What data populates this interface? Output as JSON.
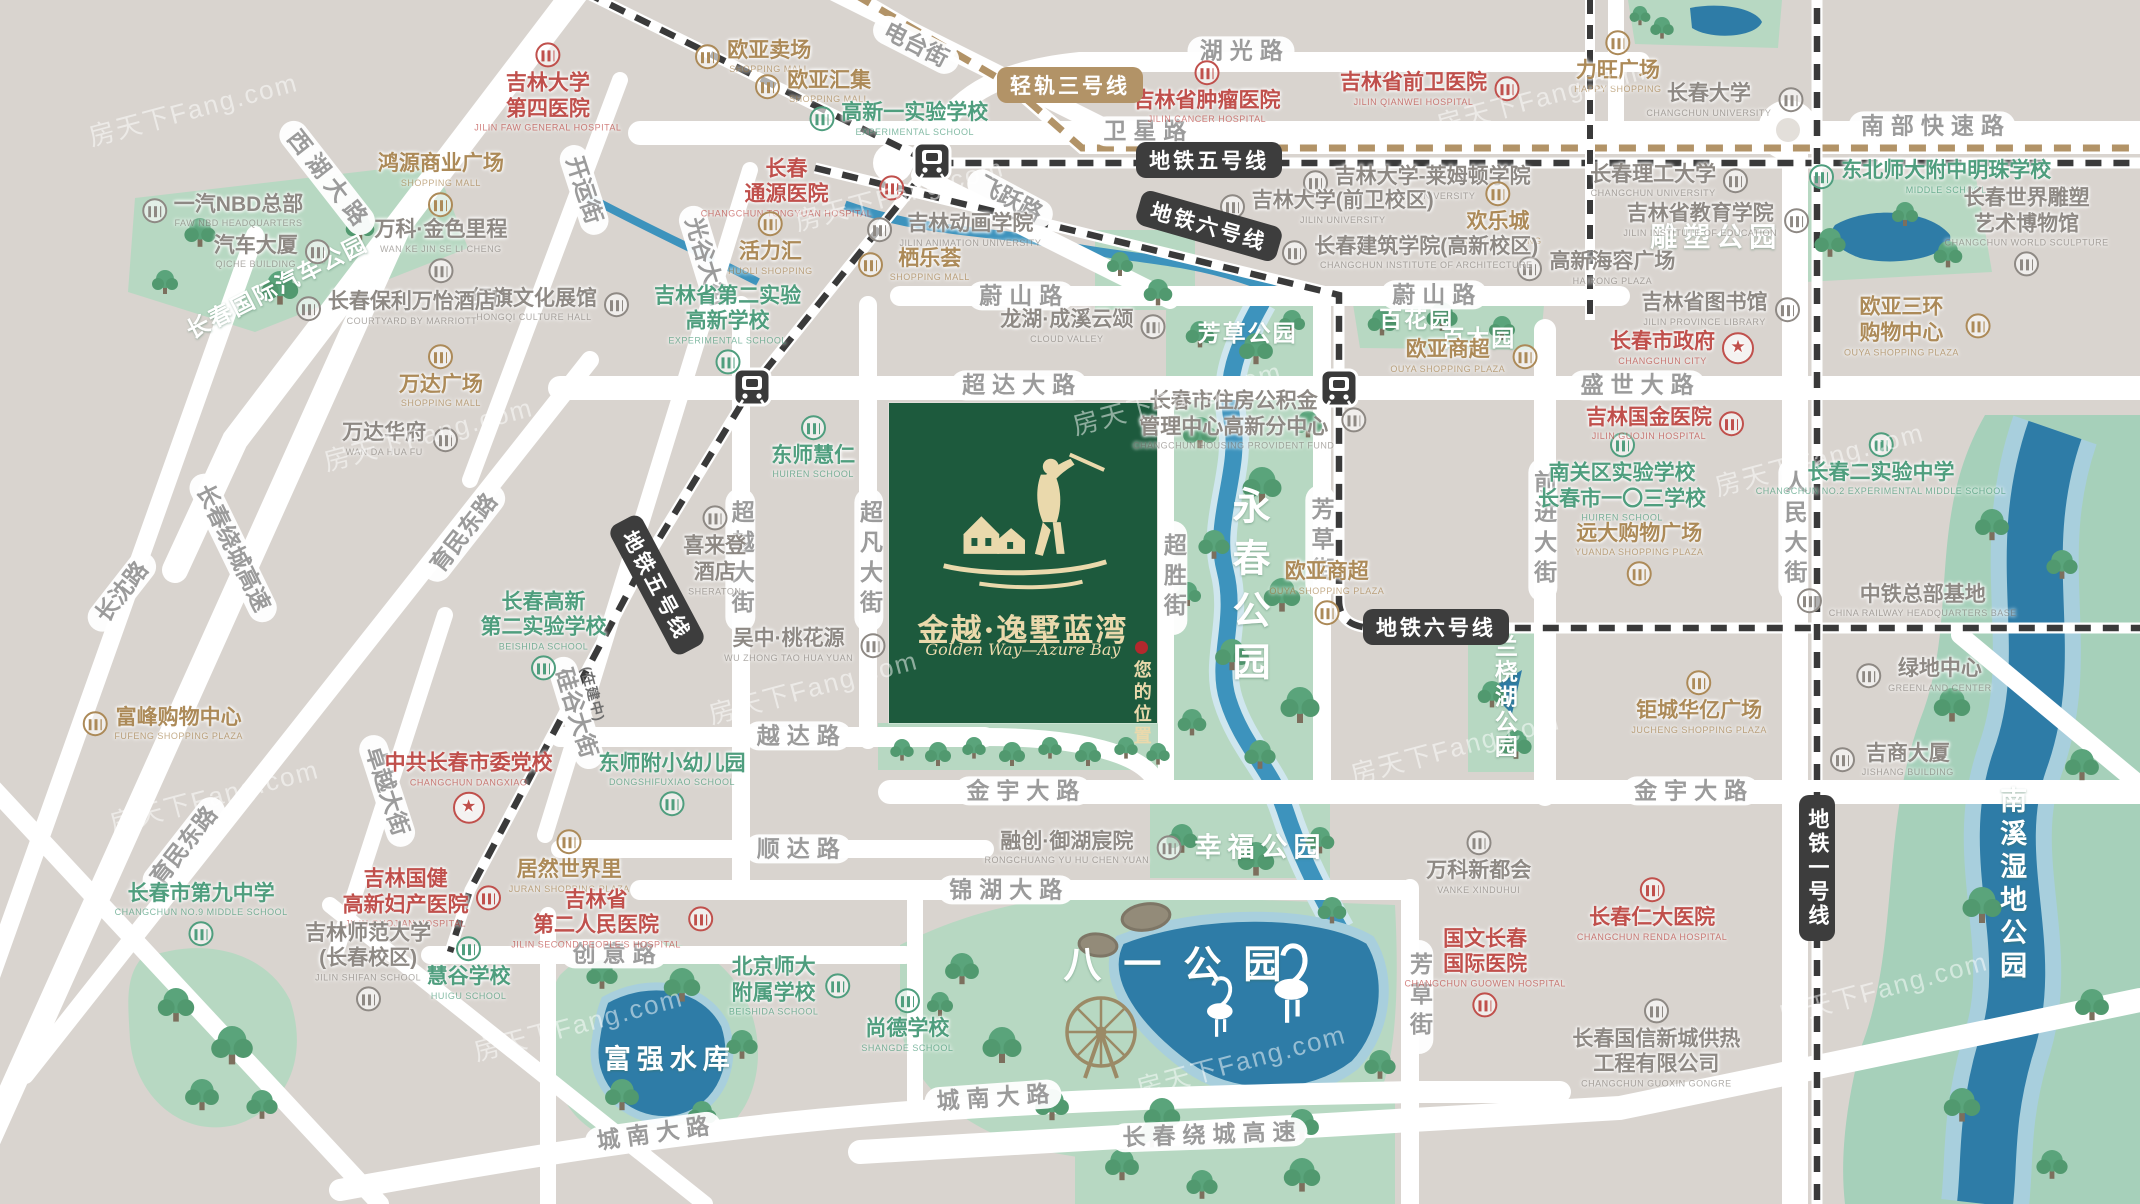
{
  "map": {
    "watermark_text": "房天下Fang.com",
    "project": {
      "name": "金越·逸墅蓝湾",
      "name_en": "Golden Way—Azure Bay",
      "marker": "您的位置"
    },
    "colors": {
      "land": "#d9d4cf",
      "road": "#ffffff",
      "park": "#b7d8c2",
      "wetland": "#a6d0ba",
      "water": "#3d93bd",
      "lake": "#2e7ca7",
      "project_green": "#1d5a3d",
      "cream": "#ead9ac",
      "hospital_red": "#c0504c",
      "commerce_tan": "#ac8a58",
      "school_green": "#4f9e7e",
      "building_gray": "#8e8984",
      "metro_dark": "#3d3d3d",
      "lightrail_tan": "#b29367"
    },
    "metro_badges": [
      {
        "t": "轻轨三号线",
        "x": 50.0,
        "y": 7.1,
        "rot": 0,
        "s": "tan"
      },
      {
        "t": "地铁五号线",
        "x": 56.5,
        "y": 13.3,
        "rot": 0,
        "s": "dark"
      },
      {
        "t": "地铁六号线",
        "x": 56.5,
        "y": 18.8,
        "rot": 16,
        "s": "dark"
      },
      {
        "t": "地铁五号线",
        "x": 30.7,
        "y": 48.6,
        "rot": 62,
        "s": "dark"
      },
      {
        "t": "(在建中)",
        "x": 27.7,
        "y": 57.6,
        "rot": 75,
        "s": "note"
      },
      {
        "t": "地铁六号线",
        "x": 67.1,
        "y": 52.1,
        "rot": 0,
        "s": "dark"
      },
      {
        "t": "地铁一号线",
        "x": 84.9,
        "y": 72.1,
        "rot": 0,
        "s": "dark",
        "vert": true
      }
    ],
    "road_labels": [
      {
        "t": "西湖大路",
        "x": 15.3,
        "y": 14.8,
        "rot": 52,
        "sp": true
      },
      {
        "t": "开运街",
        "x": 27.3,
        "y": 15.8,
        "rot": 72
      },
      {
        "t": "电台街",
        "x": 42.8,
        "y": 3.7,
        "rot": 27
      },
      {
        "t": "湖光路",
        "x": 58.0,
        "y": 4.2,
        "sp": true
      },
      {
        "t": "卫星路",
        "x": 53.5,
        "y": 10.9,
        "sp": true
      },
      {
        "t": "南部快速路",
        "x": 90.3,
        "y": 10.5,
        "sp": true
      },
      {
        "t": "飞跃路",
        "x": 47.2,
        "y": 16.5,
        "rot": 28
      },
      {
        "t": "光谷大街",
        "x": 33.0,
        "y": 21.8,
        "rot": 73
      },
      {
        "t": "蔚山路",
        "x": 47.7,
        "y": 24.6,
        "sp": true
      },
      {
        "t": "蔚山路",
        "x": 67.0,
        "y": 24.5,
        "sp": true
      },
      {
        "t": "超达大路",
        "x": 47.6,
        "y": 32.0,
        "sp": true
      },
      {
        "t": "盛世大路",
        "x": 76.5,
        "y": 32.0,
        "sp": true
      },
      {
        "t": "长春绕城高速",
        "x": 10.9,
        "y": 45.5,
        "rot": 64
      },
      {
        "t": "长沈路",
        "x": 5.7,
        "y": 49.2,
        "rot": -52
      },
      {
        "t": "育民东路",
        "x": 21.7,
        "y": 44.3,
        "rot": -52
      },
      {
        "t": "育民东路",
        "x": 8.6,
        "y": 70.3,
        "rot": -52
      },
      {
        "t": "卓越大街",
        "x": 18.1,
        "y": 65.7,
        "rot": 72
      },
      {
        "t": "硅谷大街",
        "x": 26.9,
        "y": 59.2,
        "rot": 73
      },
      {
        "t": "超越大街",
        "x": 34.6,
        "y": 46.5,
        "vert": true
      },
      {
        "t": "超凡大街",
        "x": 40.6,
        "y": 46.5,
        "vert": true
      },
      {
        "t": "超胜街",
        "x": 54.8,
        "y": 48.0,
        "vert": true
      },
      {
        "t": "芳草街",
        "x": 61.7,
        "y": 45.0,
        "vert": true
      },
      {
        "t": "前进大街",
        "x": 72.1,
        "y": 44.0,
        "vert": true
      },
      {
        "t": "人民大街",
        "x": 83.8,
        "y": 44.0,
        "vert": true
      },
      {
        "t": "越达路",
        "x": 37.3,
        "y": 61.1,
        "sp": true
      },
      {
        "t": "顺达路",
        "x": 37.3,
        "y": 70.5,
        "sp": true
      },
      {
        "t": "金宇大路",
        "x": 47.8,
        "y": 65.7,
        "sp": true
      },
      {
        "t": "金宇大路",
        "x": 79.0,
        "y": 65.7,
        "sp": true
      },
      {
        "t": "锦湖大路",
        "x": 47.0,
        "y": 73.9,
        "sp": true
      },
      {
        "t": "创意路",
        "x": 28.7,
        "y": 79.2,
        "sp": true
      },
      {
        "t": "芳草街",
        "x": 66.3,
        "y": 82.8,
        "vert": true
      },
      {
        "t": "城南大路",
        "x": 30.5,
        "y": 94.2,
        "rot": -8,
        "sp": true
      },
      {
        "t": "城南大路",
        "x": 46.4,
        "y": 91.2,
        "rot": -4,
        "sp": true
      },
      {
        "t": "长春绕城高速",
        "x": 56.5,
        "y": 94.3,
        "rot": -2,
        "sp": true
      }
    ],
    "park_labels": [
      {
        "t": "长春国际汽车公园",
        "x": 12.9,
        "y": 23.7,
        "rot": -27,
        "size": "sm"
      },
      {
        "t": "雕塑公园",
        "x": 80.2,
        "y": 19.5,
        "size": "md"
      },
      {
        "t": "百花园",
        "x": 66.2,
        "y": 26.3,
        "size": "sm"
      },
      {
        "t": "百木园",
        "x": 69.1,
        "y": 27.9,
        "size": "sm"
      },
      {
        "t": "芳草公园",
        "x": 58.3,
        "y": 27.5,
        "size": "sm"
      },
      {
        "t": "永春公园",
        "x": 58.3,
        "y": 49.0,
        "size": "lg",
        "vert": true
      },
      {
        "t": "兰桡湖公园",
        "x": 70.3,
        "y": 57.9,
        "size": "sm",
        "vert": true
      },
      {
        "t": "幸福公园",
        "x": 58.9,
        "y": 70.2,
        "size": "md"
      },
      {
        "t": "八一公园",
        "x": 55.3,
        "y": 79.8,
        "size": "lg"
      },
      {
        "t": "富强水库",
        "x": 31.3,
        "y": 87.8,
        "size": "md"
      },
      {
        "t": "南溪湿地公园",
        "x": 94.0,
        "y": 73.5,
        "size": "md",
        "vert": true
      }
    ],
    "pois": [
      {
        "t": "吉林大学",
        "t2": "第四医院",
        "en": "JILIN FAW GENERAL HOSPITAL",
        "cls": "red",
        "x": 25.6,
        "y": 7.3,
        "icon": "t"
      },
      {
        "t": "欧亚卖场",
        "en": "SHOPPING MALL",
        "cls": "tan",
        "x": 35.2,
        "y": 4.7,
        "icon": "l"
      },
      {
        "t": "欧亚汇集",
        "en": "SHOPPING MALL",
        "cls": "tan",
        "x": 38.0,
        "y": 7.2,
        "icon": "l"
      },
      {
        "t": "高新一实验学校",
        "en": "EXPERIMENTAL SCHOOL",
        "cls": "green",
        "x": 42.0,
        "y": 9.9,
        "icon": "l"
      },
      {
        "t": "吉林省肿瘤医院",
        "en": "JILIN CANCER HOSPITAL",
        "cls": "red",
        "x": 56.4,
        "y": 7.7,
        "icon": "t"
      },
      {
        "t": "吉林省前卫医院",
        "en": "JILIN QIANWEI HOSPITAL",
        "cls": "red",
        "x": 66.8,
        "y": 7.4,
        "icon": "r"
      },
      {
        "t": "力旺广场",
        "en": "HAPPY SHOPPING",
        "cls": "tan",
        "x": 75.6,
        "y": 5.2,
        "icon": "t"
      },
      {
        "t": "长春大学",
        "en": "CHANGCHUN UNIVERSITY",
        "cls": "gray",
        "x": 80.6,
        "y": 8.3,
        "icon": "r"
      },
      {
        "t": "东北师大附中明珠学校",
        "en": "MIDDLE SCHOOL",
        "cls": "green",
        "x": 90.2,
        "y": 14.7,
        "icon": "l"
      },
      {
        "t": "长春理工大学",
        "en": "CHANGCHUN UNIVERSITY",
        "cls": "gray",
        "x": 78.0,
        "y": 15.0,
        "icon": "r"
      },
      {
        "t": "吉林省教育学院",
        "en": "JILIN INSTITUTE OF EDUCATION",
        "cls": "gray",
        "x": 80.2,
        "y": 18.3,
        "icon": "r"
      },
      {
        "t": "长春世界雕塑",
        "t2": "艺术博物馆",
        "en": "CHANGCHUN WORLD SCULPTURE",
        "cls": "gray",
        "x": 94.7,
        "y": 19.2,
        "icon": "b"
      },
      {
        "t": "高新海容广场",
        "en": "HAIRONG PLAZA",
        "cls": "gray",
        "x": 74.6,
        "y": 22.3,
        "icon": "l"
      },
      {
        "t": "吉林省图书馆",
        "en": "JILIN PROVINCE LIBRARY",
        "cls": "gray",
        "x": 80.4,
        "y": 25.7,
        "icon": "r"
      },
      {
        "t": "长春市政府",
        "en": "CHANGCHUN CITY",
        "cls": "red",
        "x": 78.6,
        "y": 28.9,
        "star": "r"
      },
      {
        "t": "欧亚三环",
        "t2": "购物中心",
        "en": "OUYA SHOPPING PLAZA",
        "cls": "tan",
        "x": 89.6,
        "y": 27.1,
        "icon": "r"
      },
      {
        "t": "长春",
        "t2": "通源医院",
        "en": "CHANGCHUN TONGYUAN HOSPITAL",
        "cls": "red",
        "x": 37.5,
        "y": 15.6,
        "icon": "r"
      },
      {
        "t": "活力汇",
        "en": "HUOLI SHOPPING",
        "cls": "tan",
        "x": 36.0,
        "y": 20.3,
        "icon": "t"
      },
      {
        "t": "栖乐荟",
        "en": "SHOPPING MALL",
        "cls": "tan",
        "x": 42.7,
        "y": 22.0,
        "icon": "l"
      },
      {
        "t": "吉林动画学院",
        "en": "JILIN ANIMATION UNIVERSITY",
        "cls": "gray",
        "x": 44.6,
        "y": 19.1,
        "icon": "l"
      },
      {
        "t": "吉林大学-莱姆顿学院",
        "en": "JILIN UNIVERSITY",
        "cls": "gray",
        "x": 66.2,
        "y": 15.2,
        "icon": "l"
      },
      {
        "t": "吉林大学(前卫校区)",
        "en": "JILIN UNIVERSITY",
        "cls": "gray",
        "x": 62.0,
        "y": 17.2,
        "icon": "l"
      },
      {
        "t": "欢乐城",
        "en": "HAPPY SHOPPING",
        "cls": "tan",
        "x": 70.0,
        "y": 17.8,
        "icon": "t"
      },
      {
        "t": "长春建筑学院(高新校区)",
        "en": "CHANGCHUN INSTITUTE OF ARCHITECTURE",
        "cls": "gray",
        "x": 65.9,
        "y": 21.0,
        "icon": "l"
      },
      {
        "t": "红旗文化展馆",
        "en": "HONGQI CULTURE HALL",
        "cls": "gray",
        "x": 25.7,
        "y": 25.3,
        "icon": "r"
      },
      {
        "t": "吉林省第二实验",
        "t2": "高新学校",
        "en": "EXPERIMENTAL SCHOOL",
        "cls": "green",
        "x": 34.0,
        "y": 27.3,
        "icon": "b"
      },
      {
        "t": "鸿源商业广场",
        "en": "SHOPPING MALL",
        "cls": "tan",
        "x": 20.6,
        "y": 15.3,
        "icon": "b"
      },
      {
        "t": "一汽NBD总部",
        "en": "FAW NBD HEADQUARTERS",
        "cls": "gray",
        "x": 10.4,
        "y": 17.5,
        "icon": "l"
      },
      {
        "t": "汽车大厦",
        "en": "QICHE BUILDING",
        "cls": "gray",
        "x": 12.7,
        "y": 20.9,
        "icon": "r"
      },
      {
        "t": "万科·金色里程",
        "en": "WAN KE JIN SE LI CHENG",
        "cls": "gray",
        "x": 20.6,
        "y": 20.8,
        "icon": "b"
      },
      {
        "t": "长春保利万怡酒店",
        "en": "COURTYARD BY MARRIOTT",
        "cls": "gray",
        "x": 18.5,
        "y": 25.6,
        "icon": "l"
      },
      {
        "t": "万达广场",
        "en": "SHOPPING MALL",
        "cls": "tan",
        "x": 20.6,
        "y": 31.3,
        "icon": "t"
      },
      {
        "t": "万达华府",
        "en": "WAN DA HUA FU",
        "cls": "gray",
        "x": 18.7,
        "y": 36.5,
        "icon": "r"
      },
      {
        "t": "龙湖·成溪云颂",
        "en": "CLOUD VALLEY",
        "cls": "gray",
        "x": 50.6,
        "y": 27.1,
        "icon": "r"
      },
      {
        "t": "东师慧仁",
        "en": "HUIREN SCHOOL",
        "cls": "green",
        "x": 38.0,
        "y": 37.2,
        "icon": "t"
      },
      {
        "t": "喜来登",
        "t2": "酒店",
        "en": "SHERATON",
        "cls": "gray",
        "x": 33.4,
        "y": 45.8,
        "icon": "t"
      },
      {
        "t": "长春市住房公积金",
        "t2": "管理中心高新分中心",
        "en": "CHANGCHUN HOUSING PROVIDENT FUND",
        "cls": "gray",
        "x": 58.4,
        "y": 34.9,
        "icon": "r"
      },
      {
        "t": "欧亚商超",
        "en": "OUYA SHOPPING PLAZA",
        "cls": "tan",
        "x": 68.4,
        "y": 29.6,
        "icon": "r"
      },
      {
        "t": "欧亚商超",
        "en": "OUYA SHOPPING PLAZA",
        "cls": "tan",
        "x": 62.0,
        "y": 49.2,
        "icon": "b"
      },
      {
        "t": "南关区实验学校",
        "t2": "长春市一〇三学校",
        "en": "HUIREN SCHOOL",
        "cls": "green",
        "x": 75.8,
        "y": 39.7,
        "icon": "t"
      },
      {
        "t": "远大购物广场",
        "en": "YUANDA SHOPPING PLAZA",
        "cls": "tan",
        "x": 76.6,
        "y": 46.0,
        "icon": "b"
      },
      {
        "t": "吉林国金医院",
        "en": "JILIN GUOJIN HOSPITAL",
        "cls": "red",
        "x": 77.8,
        "y": 35.2,
        "icon": "r"
      },
      {
        "t": "长春二实验中学",
        "en": "CHANGCHUN NO.2 EXPERIMENTAL MIDDLE SCHOOL",
        "cls": "green",
        "x": 87.9,
        "y": 38.6,
        "icon": "t"
      },
      {
        "t": "中铁总部基地",
        "en": "CHINA RAILWAY HEADQUARTERS BASE",
        "cls": "gray",
        "x": 89.1,
        "y": 49.9,
        "icon": "l"
      },
      {
        "t": "绿地中心",
        "en": "GREENLAND CENTER",
        "cls": "gray",
        "x": 89.9,
        "y": 56.1,
        "icon": "l"
      },
      {
        "t": "吉商大厦",
        "en": "JISHANG BUILDING",
        "cls": "gray",
        "x": 88.4,
        "y": 63.1,
        "icon": "l"
      },
      {
        "t": "钜城华亿广场",
        "en": "JUCHENG SHOPPING PLAZA",
        "cls": "tan",
        "x": 79.4,
        "y": 58.4,
        "icon": "t"
      },
      {
        "t": "吴中·桃花源",
        "en": "WU ZHONG TAO HUA YUAN",
        "cls": "gray",
        "x": 37.6,
        "y": 53.6,
        "icon": "r"
      },
      {
        "t": "东师附小幼儿园",
        "en": "DONGSHIFUXIAO SCHOOL",
        "cls": "green",
        "x": 31.4,
        "y": 65.1,
        "icon": "b"
      },
      {
        "t": "居然世界里",
        "en": "JURAN SHOPPING PLAZA",
        "cls": "tan",
        "x": 26.6,
        "y": 71.6,
        "icon": "t"
      },
      {
        "t": "吉林省",
        "t2": "第二人民医院",
        "en": "JILIN SECOND PEOPLE'S HOSPITAL",
        "cls": "red",
        "x": 28.6,
        "y": 76.3,
        "icon": "r"
      },
      {
        "t": "吉林国健",
        "t2": "高新妇产医院",
        "en": "JILIN GUOJIAN HOSPITAL",
        "cls": "red",
        "x": 19.7,
        "y": 74.6,
        "icon": "r"
      },
      {
        "t": "中共长春市委党校",
        "en": "CHANGCHUN DANGXIAO",
        "cls": "red",
        "x": 21.9,
        "y": 65.4,
        "star": "b"
      },
      {
        "t": "长春高新",
        "t2": "第二实验学校",
        "en": "BEISHIDA SCHOOL",
        "cls": "green",
        "x": 25.4,
        "y": 52.7,
        "icon": "b"
      },
      {
        "t": "富峰购物中心",
        "en": "FUFENG SHOPPING PLAZA",
        "cls": "tan",
        "x": 7.6,
        "y": 60.1,
        "icon": "l"
      },
      {
        "t": "慧谷学校",
        "en": "HUIGU SCHOOL",
        "cls": "green",
        "x": 21.9,
        "y": 80.5,
        "icon": "t"
      },
      {
        "t": "吉林师范大学",
        "t2": "(长春校区)",
        "en": "JILIN SHIFAN SCHOOL",
        "cls": "gray",
        "x": 17.2,
        "y": 80.2,
        "icon": "b"
      },
      {
        "t": "长春市第九中学",
        "en": "CHANGCHUN NO.9 MIDDLE SCHOOL",
        "cls": "green",
        "x": 9.4,
        "y": 75.9,
        "icon": "b"
      },
      {
        "t": "北京师大",
        "t2": "附属学校",
        "en": "BEISHIDA SCHOOL",
        "cls": "green",
        "x": 36.9,
        "y": 81.9,
        "icon": "r"
      },
      {
        "t": "尚德学校",
        "en": "SHANGDE SCHOOL",
        "cls": "green",
        "x": 42.4,
        "y": 84.8,
        "icon": "t"
      },
      {
        "t": "国文长春",
        "t2": "国际医院",
        "en": "CHANGCHUN GUOWEN HOSPITAL",
        "cls": "red",
        "x": 69.4,
        "y": 80.7,
        "icon": "b"
      },
      {
        "t": "长春仁大医院",
        "en": "CHANGCHUN RENDA HOSPITAL",
        "cls": "red",
        "x": 77.2,
        "y": 75.6,
        "icon": "t"
      },
      {
        "t": "长春国信新城供热",
        "t2": "工程有限公司",
        "en": "CHANGCHUN GUOXIN GONGRE",
        "cls": "gray",
        "x": 77.4,
        "y": 86.7,
        "icon": "t"
      },
      {
        "t": "万科新都会",
        "en": "VANKE XINDUHUI",
        "cls": "gray",
        "x": 69.1,
        "y": 71.7,
        "icon": "t"
      },
      {
        "t": "融创·御湖宸院",
        "en": "RONGCHUANG YU HU CHEN YUAN",
        "cls": "gray",
        "x": 50.6,
        "y": 70.4,
        "icon": "r"
      }
    ],
    "watermarks": [
      {
        "x": 9,
        "y": 9
      },
      {
        "x": 42,
        "y": 16
      },
      {
        "x": 72,
        "y": 8
      },
      {
        "x": 20,
        "y": 36
      },
      {
        "x": 55,
        "y": 33
      },
      {
        "x": 85,
        "y": 38
      },
      {
        "x": 10,
        "y": 66
      },
      {
        "x": 38,
        "y": 57
      },
      {
        "x": 68,
        "y": 62
      },
      {
        "x": 27,
        "y": 85
      },
      {
        "x": 58,
        "y": 88
      },
      {
        "x": 88,
        "y": 82
      }
    ]
  }
}
